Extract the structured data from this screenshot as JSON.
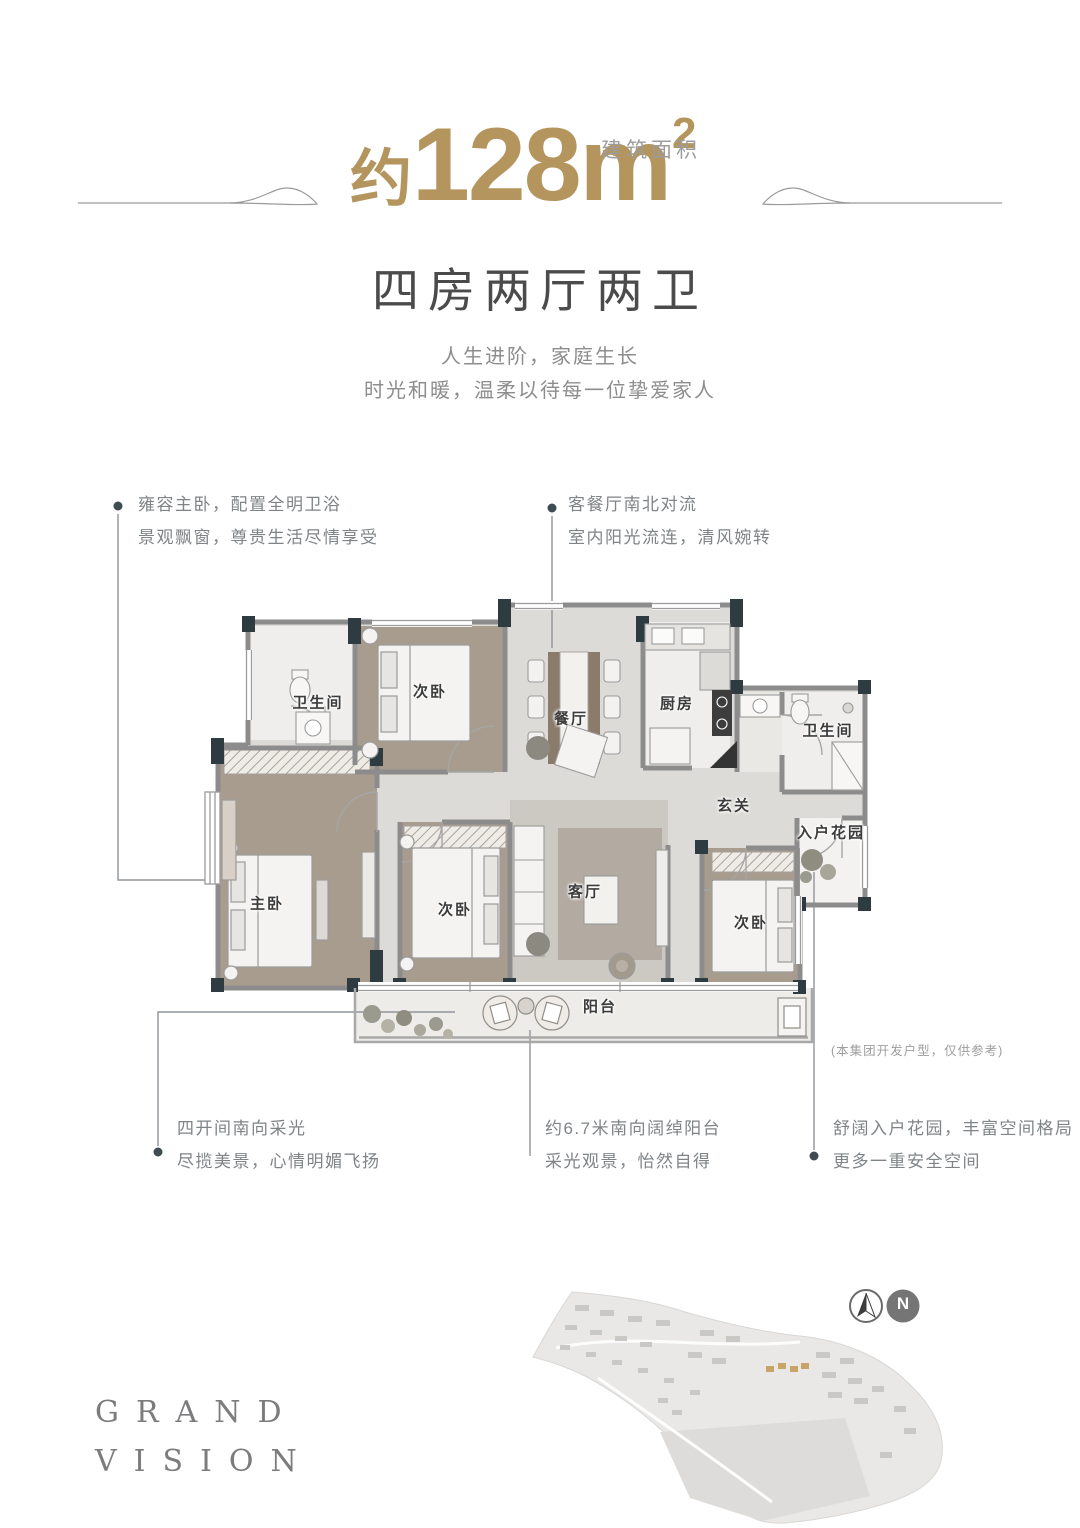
{
  "header": {
    "area_prefix": "约",
    "area_value": "128",
    "area_unit": "m",
    "area_sup": "2",
    "area_label": "建筑面积",
    "layout_title": "四房两厅两卫",
    "tagline1": "人生进阶，家庭生长",
    "tagline2": "时光和暖，温柔以待每一位挚爱家人"
  },
  "callouts": {
    "master": {
      "line1": "雍容主卧，配置全明卫浴",
      "line2": "景观飘窗，尊贵生活尽情享受"
    },
    "living_dining": {
      "line1": "客餐厅南北对流",
      "line2": "室内阳光流连，清风婉转"
    },
    "south_bays": {
      "line1": "四开间南向采光",
      "line2": "尽揽美景，心情明媚飞扬"
    },
    "balcony": {
      "line1": "约6.7米南向阔绰阳台",
      "line2": "采光观景，怡然自得"
    },
    "garden": {
      "line1": "舒阔入户花园，丰富空间格局",
      "line2": "更多一重安全空间"
    }
  },
  "plan": {
    "rooms": {
      "bath1": "卫生间",
      "bed_top": "次卧",
      "dining": "餐厅",
      "kitchen": "厨房",
      "bath2": "卫生间",
      "foyer": "玄关",
      "garden": "入户花园",
      "master": "主卧",
      "bed_mid": "次卧",
      "living": "客厅",
      "bed_right": "次卧",
      "balcony": "阳台"
    },
    "disclaimer": "(本集团开发户型，仅供参考)"
  },
  "footer": {
    "brand_line1": "GRAND",
    "brand_line2": "VISION",
    "compass_letter": "N"
  },
  "colors": {
    "gold": "#b5955e",
    "text_dark": "#4b4b4b",
    "text_gray": "#8d8d8d",
    "callout_gray": "#7f8487",
    "wall_dark": "#2e3c42",
    "wall_gray": "#8c8c8c",
    "wood_floor": "#a89c8e",
    "marble_floor": "#dcdbd7"
  }
}
